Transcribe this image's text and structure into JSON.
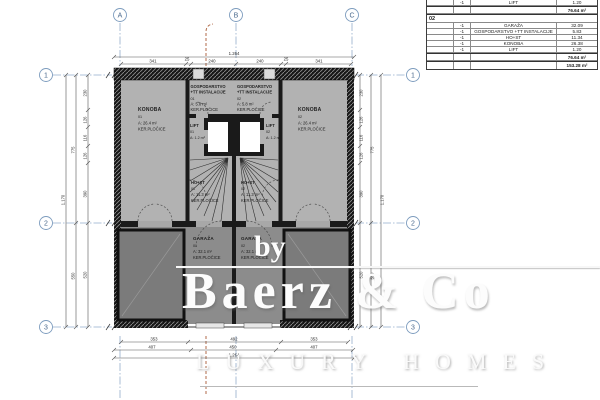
{
  "colors": {
    "wall": "#1a1a1a",
    "room_fill": "#b2b2b2",
    "garage_fill": "#8c8c8c",
    "garage_block_fill": "#7b7b7b",
    "grid_line": "#93accb",
    "grid_bubble_stroke": "#7d9cbe",
    "utility_line": "#b06a48",
    "dimension": "#555555"
  },
  "grid": {
    "cols": [
      "A",
      "B",
      "C"
    ],
    "rows": [
      "1",
      "2",
      "3"
    ]
  },
  "dims": {
    "top_total": "1.264",
    "top_segments": [
      "341",
      "25",
      "240",
      "240",
      "25",
      "341"
    ],
    "bottom_row1": [
      "353",
      "492",
      "353"
    ],
    "bottom_row2": [
      "407",
      "450",
      "407"
    ],
    "bottom_total": "1.264",
    "v_segments": [
      "230",
      "126",
      "116",
      "126",
      "390",
      "520"
    ],
    "v_mid_upper": "775",
    "v_mid_lower": "550",
    "v_total": "1.170"
  },
  "rooms": {
    "konoba_l": {
      "name": "KONOBA",
      "num": "01",
      "area": "A: 26.4 m²",
      "finish": "KER.PLOČICE"
    },
    "konoba_r": {
      "name": "KONOBA",
      "num": "02",
      "area": "A: 26.4 m²",
      "finish": "KER.PLOČICE"
    },
    "gosp_l": {
      "name1": "GOSPODARSTVO",
      "name2": "+TT INSTALACIJE",
      "num": "01",
      "area": "A: 5.8 m²",
      "finish": "KER.PLOČICE"
    },
    "gosp_r": {
      "name1": "GOSPODARSTVO",
      "name2": "+TT INSTALACIJE",
      "num": "02",
      "area": "A: 5.8 m²",
      "finish": "KER.PLOČICE"
    },
    "lift_l": {
      "name": "LIFT",
      "num": "01",
      "area": "A: 1.2 m²"
    },
    "lift_r": {
      "name": "LIFT",
      "num": "02",
      "area": "A: 1.2 m²"
    },
    "host_l": {
      "name": "HO+ST",
      "num": "01",
      "area": "A: 11.3 m²",
      "finish": "KER.PLOČICE"
    },
    "host_r": {
      "name": "HO+ST",
      "num": "02",
      "area": "A: 11.3 m²",
      "finish": "KER.PLOČICE"
    },
    "garaza_l": {
      "name": "GARAŽA",
      "num": "01",
      "area": "A: 32.1 m²",
      "finish": "KER.PLOČICE"
    },
    "garaza_r": {
      "name": "GARAŽA",
      "num": "02",
      "area": "A: 32.1 m²",
      "finish": "KER.PLOČICE"
    }
  },
  "table": {
    "top_row": {
      "unit": "-1",
      "name": "LIFT",
      "value": "1.20"
    },
    "subtotal_top": "76.64 m²",
    "section": "02",
    "rows": [
      {
        "unit": "-1",
        "name": "GARAŽA",
        "value": "32.09"
      },
      {
        "unit": "-1",
        "name": "GOSPODARSTVO +TT INSTALACIJE",
        "value": "5.83"
      },
      {
        "unit": "-1",
        "name": "HO+ST",
        "value": "11.34"
      },
      {
        "unit": "-1",
        "name": "KONOBA",
        "value": "26.38"
      },
      {
        "unit": "-1",
        "name": "LIFT",
        "value": "1.20"
      }
    ],
    "subtotal": "76.64 m²",
    "total": "153.28 m²"
  },
  "watermark": {
    "by": "by",
    "brand": "Baerz & Co",
    "tagline": "LUXURY HOMES"
  }
}
